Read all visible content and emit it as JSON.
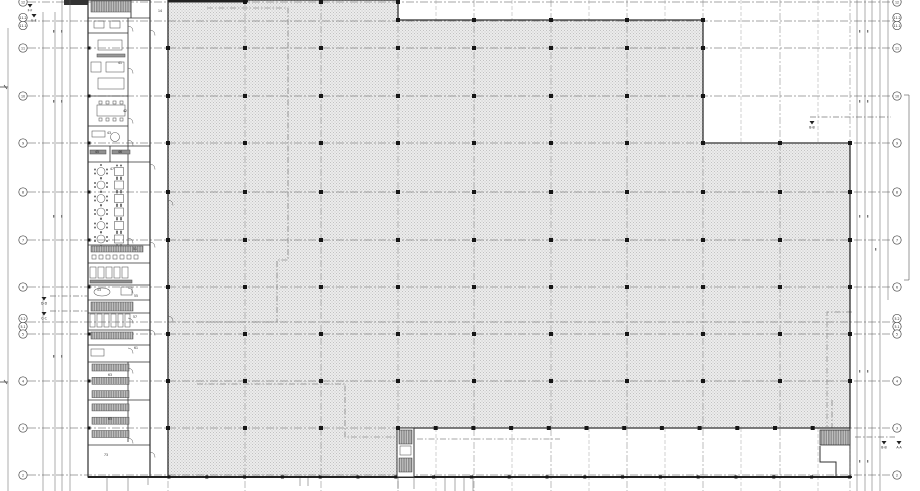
{
  "sheet": {
    "background": "#ffffff",
    "hatch_base": "#ececec",
    "hatch_dot": "#c2c2c2",
    "wall_color": "#2f2f2f",
    "grid_color": "#878787",
    "column_color": "#161616"
  },
  "grid": {
    "row_labels": [
      {
        "label": "12"
      },
      {
        "label": "11.1",
        "label2": "11.2"
      },
      {
        "label": "11"
      },
      {
        "label": "10"
      },
      {
        "label": "9"
      },
      {
        "label": "8"
      },
      {
        "label": "7"
      },
      {
        "label": "6"
      },
      {
        "label": "5.1",
        "label2": "5.2"
      },
      {
        "label": "5"
      },
      {
        "label": "4"
      },
      {
        "label": "3"
      },
      {
        "label": "2"
      }
    ]
  },
  "section_markers": [
    {
      "label": "F-F"
    },
    {
      "label": "E-E"
    },
    {
      "label": "D-D"
    },
    {
      "label": "C-C"
    },
    {
      "label": "B-B"
    },
    {
      "label": "B-B"
    },
    {
      "label": "A-A"
    }
  ],
  "room_numbers": [
    {
      "number": "41"
    },
    {
      "number": "42"
    },
    {
      "number": "43"
    },
    {
      "number": "45"
    },
    {
      "number": "46"
    },
    {
      "number": "47"
    },
    {
      "number": "51"
    },
    {
      "number": "53"
    },
    {
      "number": "55"
    },
    {
      "number": "57"
    },
    {
      "number": "61"
    },
    {
      "number": "63"
    },
    {
      "number": "65"
    },
    {
      "number": "73"
    },
    {
      "number": "14"
    }
  ]
}
